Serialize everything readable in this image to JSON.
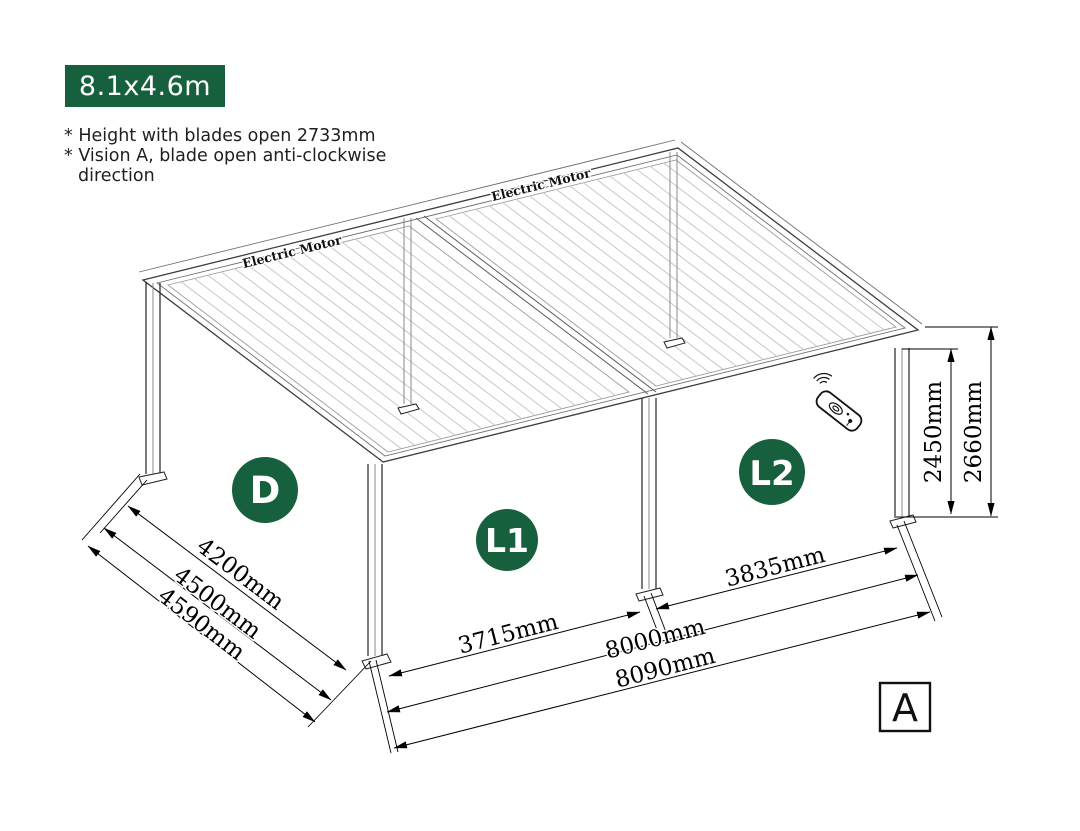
{
  "badge": {
    "label": "8.1x4.6m"
  },
  "notes": {
    "line1": "* Height with blades open 2733mm",
    "line2": "* Vision A, blade open anti-clockwise direction"
  },
  "pergola": {
    "motor_label": "Electric Motor",
    "zones": {
      "side": "D",
      "front_left": "L1",
      "front_right": "L2"
    },
    "view_marker": "A"
  },
  "dimensions": {
    "side_inner": "4200mm",
    "side_frame": "4500mm",
    "side_total": "4590mm",
    "front_left_opening": "3715mm",
    "front_right_opening": "3835mm",
    "width_frame": "8000mm",
    "width_total": "8090mm",
    "post_height": "2450mm",
    "total_height": "2660mm"
  },
  "icons": {
    "remote": "remote-control-icon",
    "wireless": "wireless-signal-arcs"
  },
  "colors": {
    "accent_green": "#17603d",
    "ink": "#000000",
    "louver_gray": "#c7c7c7"
  }
}
